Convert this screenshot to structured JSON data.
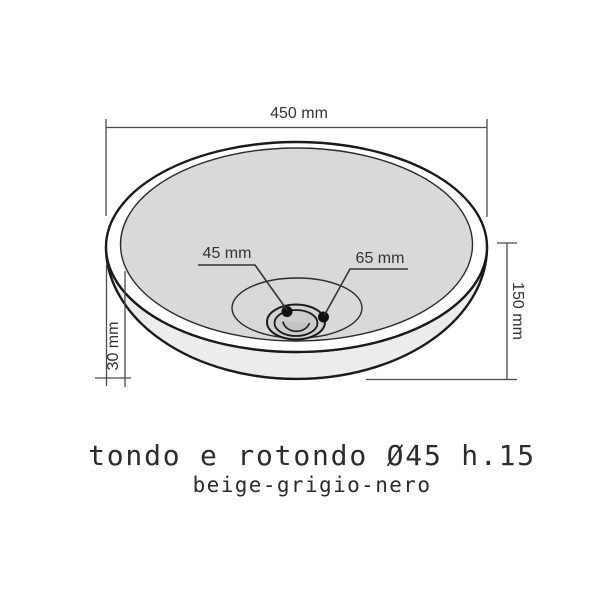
{
  "diagram": {
    "dims": {
      "width": "450 mm",
      "height": "150 mm",
      "rim": "30 mm",
      "drain_inner": "45 mm",
      "drain_outer": "65 mm"
    },
    "caption": {
      "title": "tondo e rotondo Ø45 h.15",
      "subtitle": "beige-grigio-nero"
    },
    "colors": {
      "background": "#ffffff",
      "rim_fill": "#ffffff",
      "basin_fill": "#d9d9d9",
      "wall_fill": "#ececec",
      "recess_fill": "#d9d9d9",
      "drain_ring_fill": "#d2d2d2",
      "drain_inner_fill": "#cccccc",
      "drain_hole_fill": "#c3c3c3",
      "outline": "#1a1a1a",
      "thin_outline": "#2a2a2a",
      "leader_line": "#333333",
      "dim_line": "#4a4a4a",
      "dot": "#111111",
      "label_text": "#333333",
      "caption_text": "#2b2b2b"
    }
  }
}
